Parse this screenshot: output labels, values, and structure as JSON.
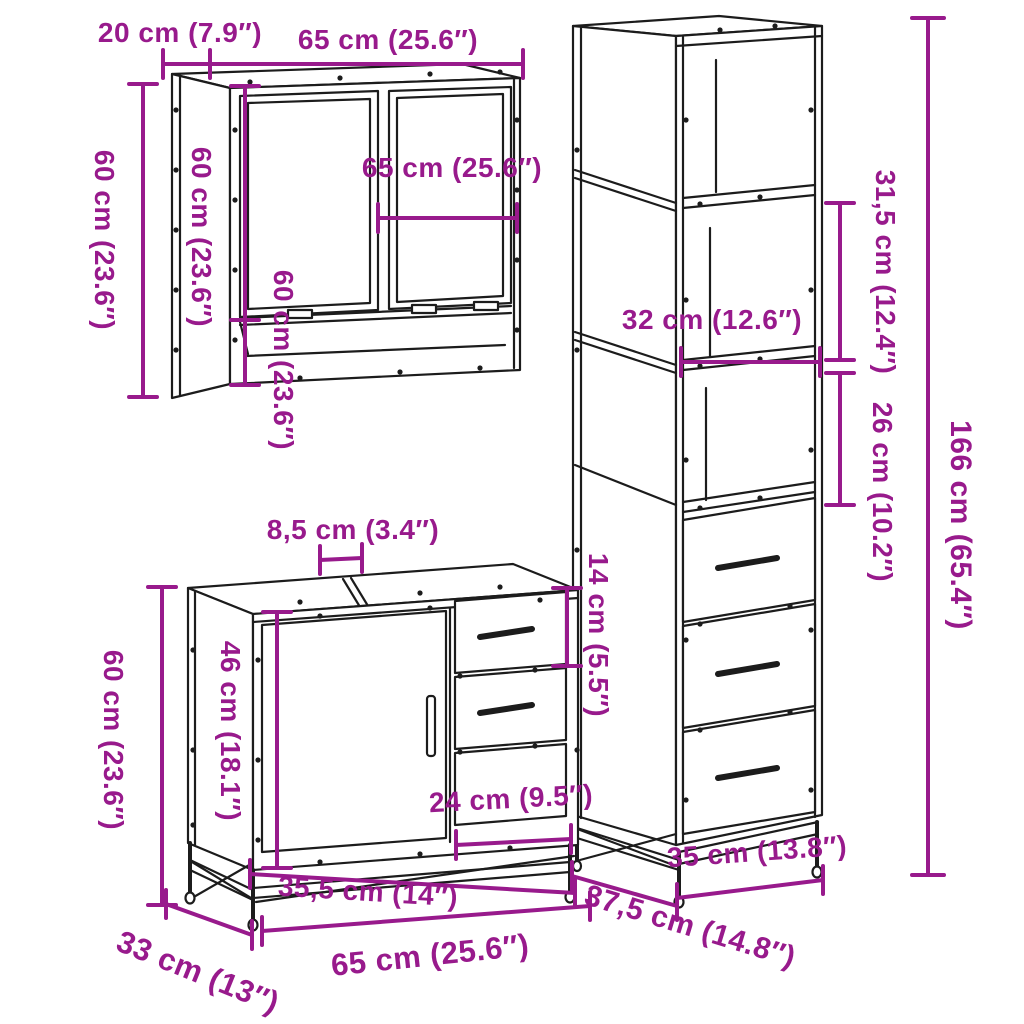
{
  "colors": {
    "accent": "#981a8c",
    "line": "#1c1c1c",
    "background": "#ffffff"
  },
  "mirror_cabinet": {
    "depth": "20 cm (7.9″)",
    "width_top": "65 cm (25.6″)",
    "height_outer": "60 cm (23.6″)",
    "height_side": "60 cm (23.6″)",
    "height_inner": "60 cm (23.6″)",
    "mirror_width": "65 cm (25.6″)"
  },
  "tall_cabinet": {
    "top_section_height": "31,5 cm (12.4″)",
    "shelf_width": "32 cm (12.6″)",
    "middle_section_height": "26 cm (10.2″)",
    "total_height": "166 cm (65.4″)",
    "width": "35 cm (13.8″)",
    "depth": "37,5 cm (14.8″)"
  },
  "vanity_cabinet": {
    "top_gap": "8,5 cm (3.4″)",
    "height": "60 cm (23.6″)",
    "door_height": "46 cm (18.1″)",
    "drawer_height": "14 cm (5.5″)",
    "drawer_width": "24 cm (9.5″)",
    "front_width": "35,5 cm (14″)",
    "depth": "33 cm (13″)",
    "width": "65 cm (25.6″)"
  }
}
